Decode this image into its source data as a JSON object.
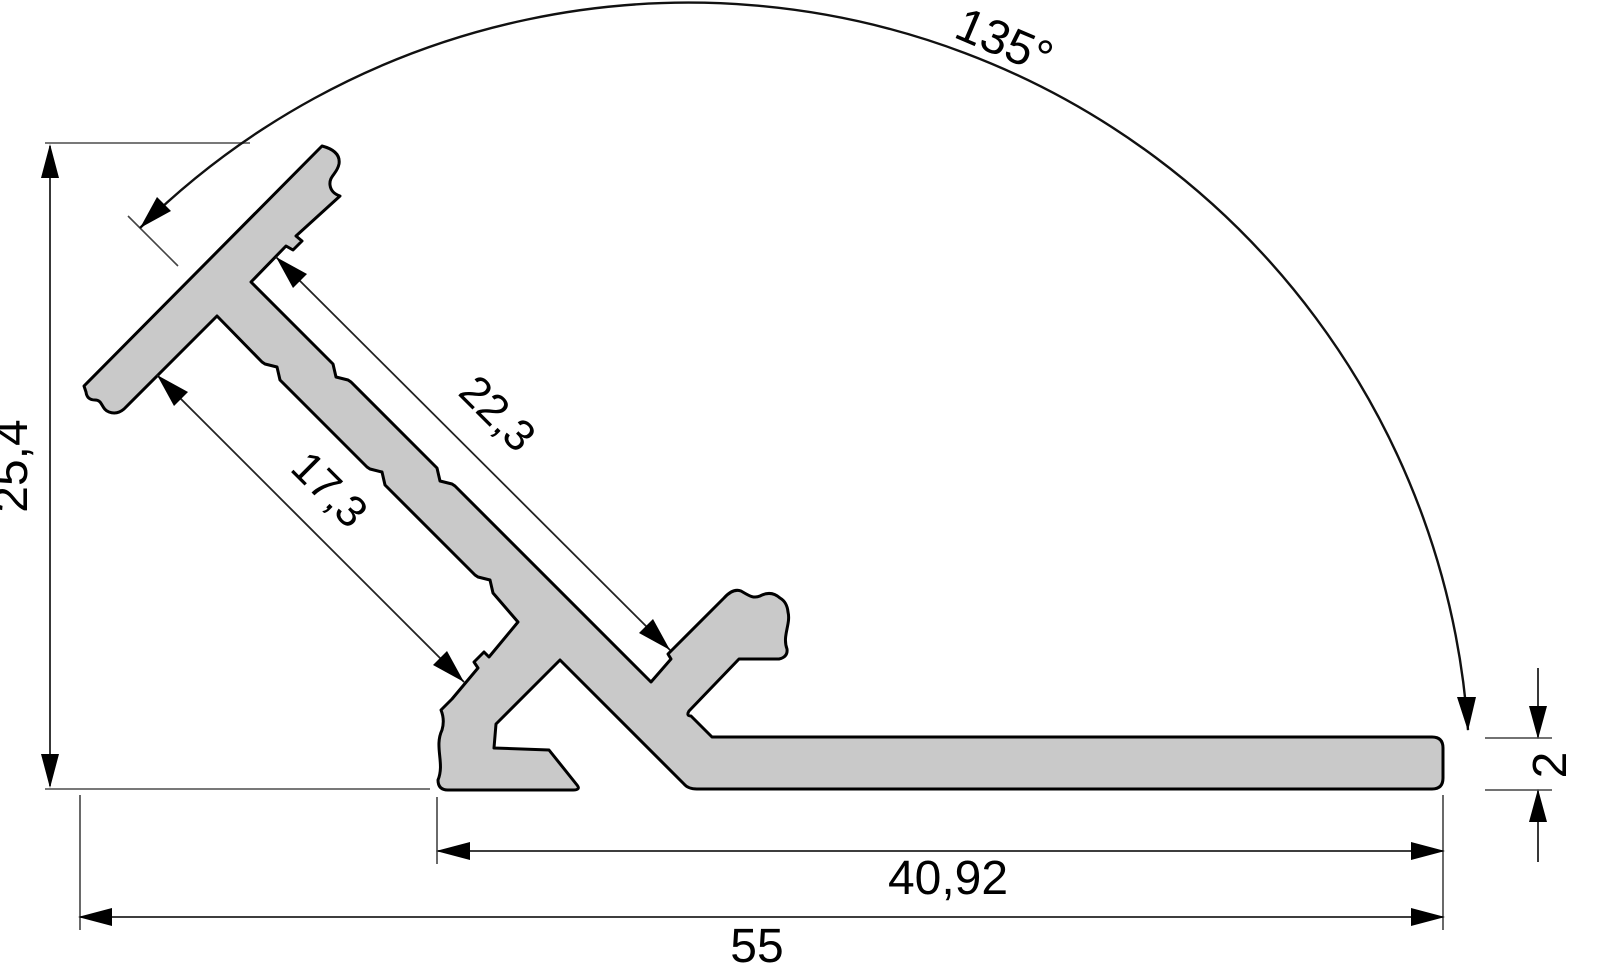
{
  "drawing": {
    "kind": "aluminium-corner-profile-cross-section",
    "dimensions": {
      "angle": "135°",
      "overall_height": "25,4",
      "upper_wing_length": "22,3",
      "lower_wing_length": "17,3",
      "base_width": "40,92",
      "overall_width": "55",
      "base_thickness": "2"
    },
    "colors": {
      "profile_fill": "#c9c9c9",
      "outline": "#000000",
      "dimension_line": "#222222",
      "extension_line": "#787878",
      "background": "#ffffff"
    }
  }
}
